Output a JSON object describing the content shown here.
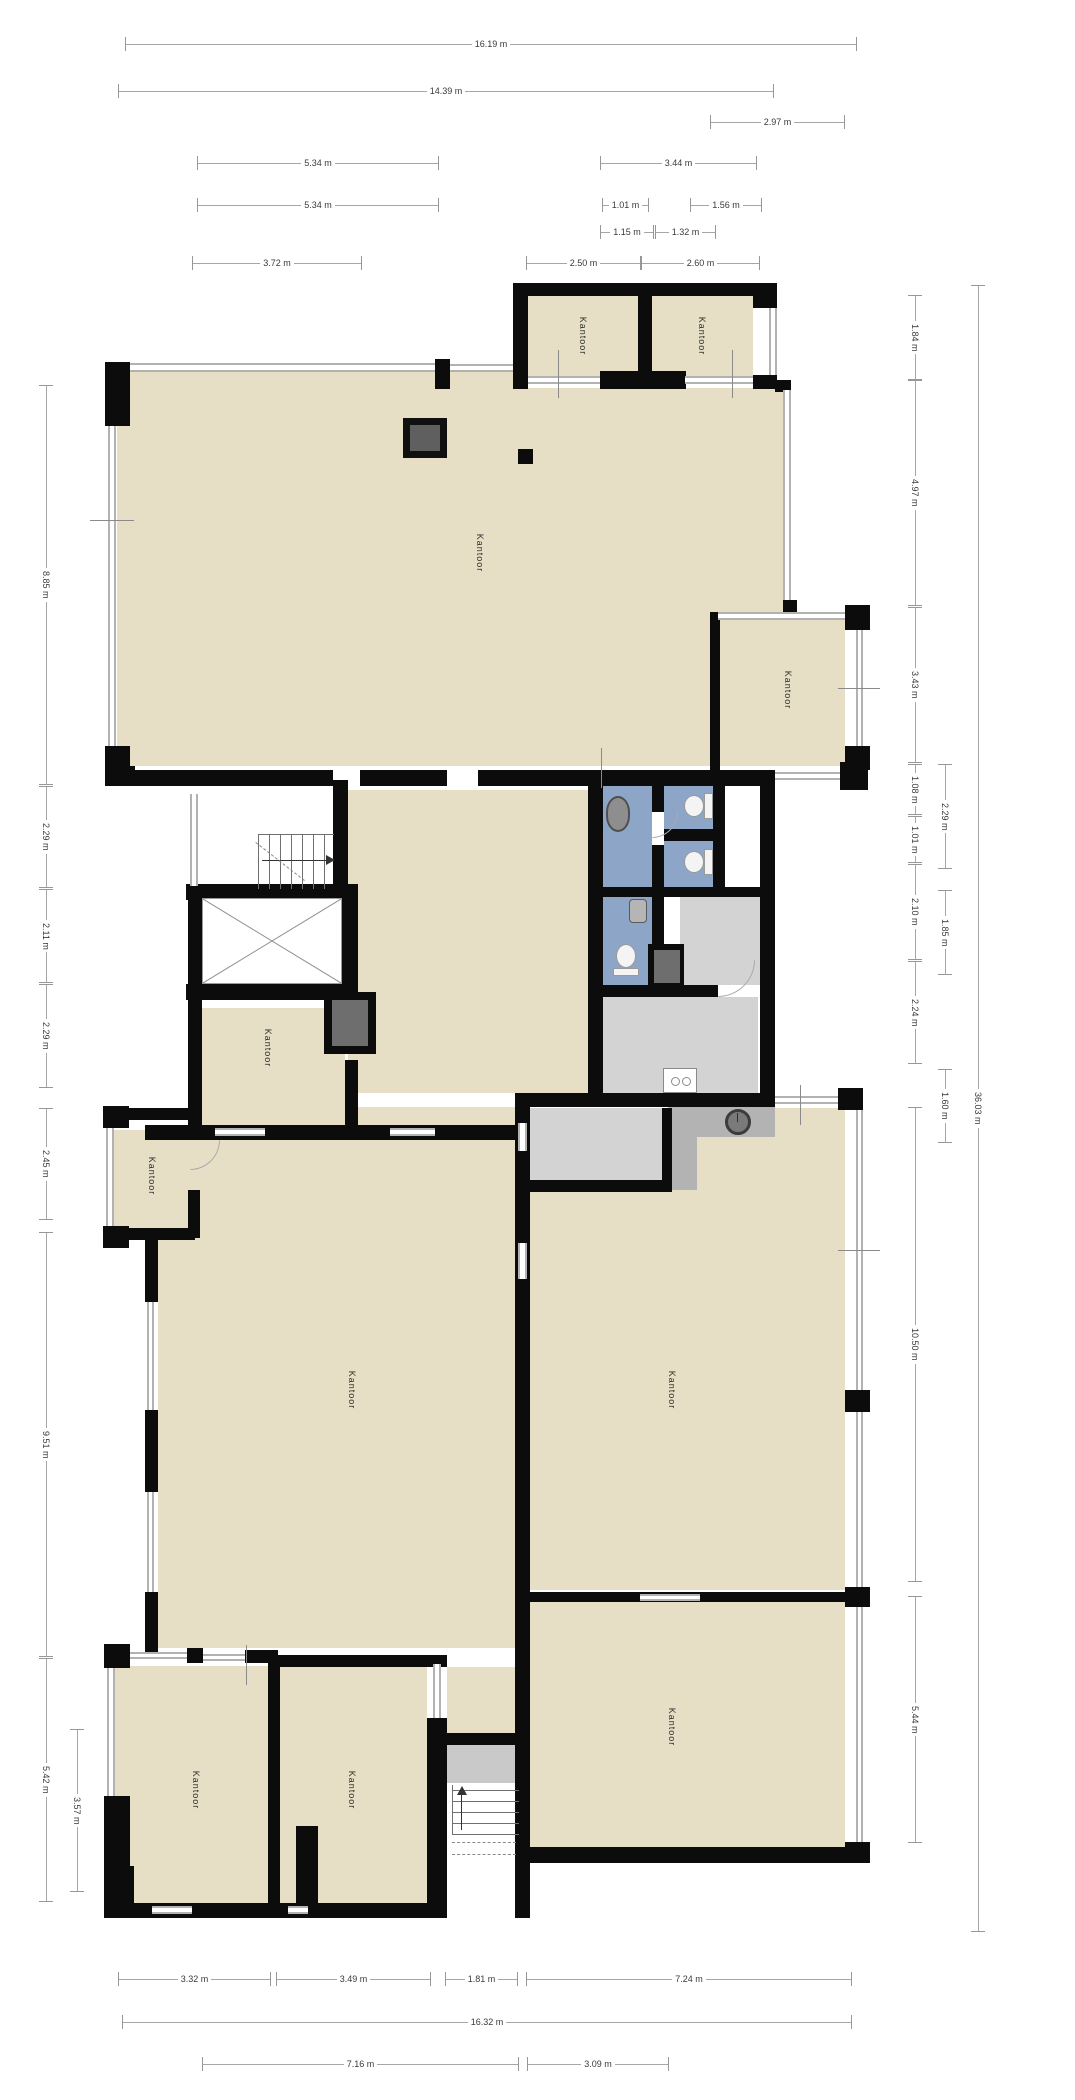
{
  "title": "Floor plan",
  "unit": "m",
  "room_label_text": "Kantoor",
  "palette": {
    "room_fill": "#e7dfc5",
    "sanitary_fill": "#8da5c7",
    "utility_fill": "#d3d3d3",
    "entry_fill": "#b3b3b3",
    "wall": "#0c0c0c",
    "window_line": "#b2b2b2",
    "dimension_line": "#a6a6a6",
    "text": "#3a3a3a"
  },
  "rooms": [
    {
      "label": "Kantoor",
      "x": 583,
      "y": 336
    },
    {
      "label": "Kantoor",
      "x": 702,
      "y": 336
    },
    {
      "label": "Kantoor",
      "x": 480,
      "y": 553
    },
    {
      "label": "Kantoor",
      "x": 788,
      "y": 690
    },
    {
      "label": "Kantoor",
      "x": 268,
      "y": 1048
    },
    {
      "label": "Kantoor",
      "x": 152,
      "y": 1176
    },
    {
      "label": "Kantoor",
      "x": 352,
      "y": 1390
    },
    {
      "label": "Kantoor",
      "x": 672,
      "y": 1390
    },
    {
      "label": "Kantoor",
      "x": 672,
      "y": 1727
    },
    {
      "label": "Kantoor",
      "x": 196,
      "y": 1790
    },
    {
      "label": "Kantoor",
      "x": 352,
      "y": 1790
    }
  ],
  "dims": {
    "h": [
      {
        "t": "16.19 m",
        "x": 125,
        "y": 44,
        "w": 730
      },
      {
        "t": "14.39 m",
        "x": 118,
        "y": 91,
        "w": 654
      },
      {
        "t": "2.97 m",
        "x": 710,
        "y": 122,
        "w": 133
      },
      {
        "t": "5.34 m",
        "x": 197,
        "y": 163,
        "w": 240
      },
      {
        "t": "3.44 m",
        "x": 600,
        "y": 163,
        "w": 155
      },
      {
        "t": "5.34 m",
        "x": 197,
        "y": 205,
        "w": 240
      },
      {
        "t": "1.01 m",
        "x": 602,
        "y": 205,
        "w": 45
      },
      {
        "t": "1.56 m",
        "x": 690,
        "y": 205,
        "w": 70
      },
      {
        "t": "1.15 m",
        "x": 600,
        "y": 232,
        "w": 52
      },
      {
        "t": "1.32 m",
        "x": 655,
        "y": 232,
        "w": 59
      },
      {
        "t": "3.72 m",
        "x": 192,
        "y": 263,
        "w": 168
      },
      {
        "t": "2.50 m",
        "x": 526,
        "y": 263,
        "w": 113
      },
      {
        "t": "2.60 m",
        "x": 641,
        "y": 263,
        "w": 117
      },
      {
        "t": "3.32 m",
        "x": 118,
        "y": 1979,
        "w": 151
      },
      {
        "t": "3.49 m",
        "x": 276,
        "y": 1979,
        "w": 153
      },
      {
        "t": "1.81 m",
        "x": 445,
        "y": 1979,
        "w": 71
      },
      {
        "t": "7.24 m",
        "x": 526,
        "y": 1979,
        "w": 324
      },
      {
        "t": "16.32 m",
        "x": 122,
        "y": 2022,
        "w": 728
      },
      {
        "t": "7.16 m",
        "x": 202,
        "y": 2064,
        "w": 315
      },
      {
        "t": "3.09 m",
        "x": 527,
        "y": 2064,
        "w": 140
      }
    ],
    "v": [
      {
        "t": "8.85 m",
        "x": 46,
        "y": 385,
        "h": 398
      },
      {
        "t": "2.29 m",
        "x": 46,
        "y": 786,
        "h": 100
      },
      {
        "t": "2.11 m",
        "x": 46,
        "y": 889,
        "h": 92
      },
      {
        "t": "2.29 m",
        "x": 46,
        "y": 984,
        "h": 102
      },
      {
        "t": "2.45 m",
        "x": 46,
        "y": 1108,
        "h": 110
      },
      {
        "t": "9.51 m",
        "x": 46,
        "y": 1232,
        "h": 423
      },
      {
        "t": "5.42 m",
        "x": 46,
        "y": 1658,
        "h": 242
      },
      {
        "t": "3.57 m",
        "x": 77,
        "y": 1729,
        "h": 161
      },
      {
        "t": "1.84 m",
        "x": 915,
        "y": 295,
        "h": 83
      },
      {
        "t": "4.97 m",
        "x": 915,
        "y": 380,
        "h": 224
      },
      {
        "t": "3.43 m",
        "x": 915,
        "y": 607,
        "h": 154
      },
      {
        "t": "1.08 m",
        "x": 915,
        "y": 764,
        "h": 49
      },
      {
        "t": "1.01 m",
        "x": 915,
        "y": 816,
        "h": 45
      },
      {
        "t": "2.10 m",
        "x": 915,
        "y": 864,
        "h": 94
      },
      {
        "t": "2.24 m",
        "x": 915,
        "y": 961,
        "h": 101
      },
      {
        "t": "10.50 m",
        "x": 915,
        "y": 1107,
        "h": 473
      },
      {
        "t": "5.44 m",
        "x": 915,
        "y": 1596,
        "h": 245
      },
      {
        "t": "2.29 m",
        "x": 945,
        "y": 764,
        "h": 103
      },
      {
        "t": "1.85 m",
        "x": 945,
        "y": 890,
        "h": 83
      },
      {
        "t": "1.60 m",
        "x": 945,
        "y": 1069,
        "h": 72
      },
      {
        "t": "36.03 m",
        "x": 978,
        "y": 285,
        "h": 1645
      }
    ]
  },
  "plan": {
    "fills": [
      [
        527,
        296,
        112,
        80,
        "beige"
      ],
      [
        652,
        296,
        101,
        80,
        "beige"
      ],
      [
        117,
        371,
        398,
        395,
        "beige"
      ],
      [
        515,
        388,
        268,
        378,
        "beige"
      ],
      [
        718,
        620,
        127,
        146,
        "beige"
      ],
      [
        348,
        790,
        240,
        303,
        "beige"
      ],
      [
        200,
        1008,
        145,
        117,
        "beige"
      ],
      [
        114,
        1130,
        74,
        98,
        "beige"
      ],
      [
        158,
        1140,
        357,
        508,
        "beige"
      ],
      [
        348,
        1107,
        167,
        18,
        "beige"
      ],
      [
        530,
        1190,
        315,
        400,
        "beige"
      ],
      [
        775,
        1108,
        70,
        82,
        "beige"
      ],
      [
        697,
        1133,
        78,
        57,
        "beige"
      ],
      [
        530,
        1602,
        315,
        245,
        "beige"
      ],
      [
        114,
        1666,
        154,
        237,
        "beige"
      ],
      [
        280,
        1667,
        147,
        236,
        "beige"
      ],
      [
        447,
        1667,
        68,
        78,
        "beige"
      ],
      [
        198,
        790,
        137,
        96,
        "white"
      ],
      [
        725,
        782,
        35,
        105,
        "white"
      ],
      [
        602,
        782,
        50,
        105,
        "blue"
      ],
      [
        664,
        782,
        49,
        47,
        "blue"
      ],
      [
        664,
        841,
        49,
        46,
        "blue"
      ],
      [
        600,
        897,
        52,
        88,
        "blue"
      ],
      [
        680,
        897,
        80,
        88,
        "lgray"
      ],
      [
        602,
        997,
        156,
        96,
        "lgray"
      ],
      [
        530,
        1108,
        132,
        72,
        "lgray"
      ],
      [
        668,
        1107,
        107,
        30,
        "mgray"
      ],
      [
        668,
        1137,
        29,
        53,
        "mgray"
      ],
      [
        447,
        1745,
        81,
        158,
        "white"
      ],
      [
        447,
        1745,
        81,
        38,
        "landing"
      ]
    ],
    "walls": [
      [
        513,
        283,
        264,
        13
      ],
      [
        513,
        283,
        15,
        106
      ],
      [
        638,
        293,
        14,
        96
      ],
      [
        753,
        283,
        24,
        25
      ],
      [
        753,
        375,
        24,
        14
      ],
      [
        600,
        371,
        86,
        18
      ],
      [
        105,
        362,
        25,
        64
      ],
      [
        435,
        359,
        15,
        30
      ],
      [
        105,
        746,
        25,
        26
      ],
      [
        105,
        766,
        30,
        20
      ],
      [
        135,
        770,
        198,
        16
      ],
      [
        360,
        770,
        87,
        16
      ],
      [
        478,
        770,
        117,
        16
      ],
      [
        588,
        770,
        187,
        16
      ],
      [
        840,
        762,
        28,
        28
      ],
      [
        775,
        380,
        16,
        12
      ],
      [
        783,
        600,
        14,
        14
      ],
      [
        710,
        612,
        10,
        158
      ],
      [
        845,
        605,
        25,
        25
      ],
      [
        845,
        746,
        25,
        24
      ],
      [
        188,
        884,
        16,
        116
      ],
      [
        333,
        780,
        15,
        106
      ],
      [
        186,
        884,
        172,
        16
      ],
      [
        186,
        984,
        172,
        16
      ],
      [
        342,
        884,
        16,
        116
      ],
      [
        324,
        992,
        52,
        62
      ],
      [
        188,
        994,
        14,
        140
      ],
      [
        345,
        994,
        13,
        40
      ],
      [
        345,
        1060,
        13,
        74
      ],
      [
        145,
        1125,
        375,
        15
      ],
      [
        103,
        1106,
        26,
        22
      ],
      [
        103,
        1226,
        26,
        22
      ],
      [
        129,
        1108,
        60,
        12
      ],
      [
        129,
        1228,
        66,
        12
      ],
      [
        188,
        1108,
        12,
        30
      ],
      [
        188,
        1190,
        12,
        48
      ],
      [
        145,
        1240,
        13,
        62
      ],
      [
        145,
        1410,
        13,
        82
      ],
      [
        145,
        1592,
        13,
        66
      ],
      [
        515,
        1107,
        15,
        811
      ],
      [
        588,
        770,
        15,
        337
      ],
      [
        760,
        782,
        15,
        325
      ],
      [
        652,
        782,
        12,
        30
      ],
      [
        652,
        845,
        12,
        42
      ],
      [
        664,
        829,
        49,
        12
      ],
      [
        713,
        782,
        12,
        105
      ],
      [
        588,
        887,
        184,
        10
      ],
      [
        652,
        897,
        12,
        51
      ],
      [
        648,
        944,
        36,
        45
      ],
      [
        588,
        985,
        130,
        12
      ],
      [
        515,
        1093,
        260,
        14
      ],
      [
        838,
        1088,
        25,
        22
      ],
      [
        530,
        1180,
        142,
        12
      ],
      [
        662,
        1108,
        10,
        84
      ],
      [
        530,
        1592,
        325,
        10
      ],
      [
        528,
        1847,
        335,
        16
      ],
      [
        845,
        1390,
        25,
        22
      ],
      [
        845,
        1587,
        25,
        20
      ],
      [
        845,
        1842,
        25,
        21
      ],
      [
        427,
        1718,
        20,
        200
      ],
      [
        447,
        1733,
        81,
        12
      ],
      [
        104,
        1644,
        26,
        24
      ],
      [
        187,
        1648,
        16,
        15
      ],
      [
        245,
        1650,
        33,
        13
      ],
      [
        268,
        1655,
        179,
        12
      ],
      [
        268,
        1655,
        12,
        263
      ],
      [
        104,
        1796,
        26,
        74
      ],
      [
        104,
        1866,
        30,
        52
      ],
      [
        104,
        1903,
        343,
        15
      ],
      [
        296,
        1826,
        22,
        80
      ],
      [
        518,
        449,
        15,
        15
      ]
    ],
    "windows": {
      "h": [
        [
          130,
          363,
          305,
          9
        ],
        [
          450,
          364,
          63,
          8
        ],
        [
          528,
          376,
          72,
          8
        ],
        [
          685,
          376,
          68,
          8
        ],
        [
          775,
          772,
          65,
          8
        ],
        [
          718,
          612,
          127,
          8
        ],
        [
          775,
          1096,
          63,
          8
        ],
        [
          130,
          1652,
          57,
          7
        ],
        [
          203,
          1654,
          42,
          7
        ],
        [
          152,
          1906,
          40,
          8
        ],
        [
          288,
          1906,
          20,
          8
        ],
        [
          215,
          1128,
          50,
          8
        ],
        [
          390,
          1128,
          45,
          8
        ],
        [
          640,
          1594,
          60,
          7
        ]
      ],
      "v": [
        [
          108,
          426,
          8,
          320
        ],
        [
          769,
          308,
          8,
          67
        ],
        [
          783,
          390,
          8,
          210
        ],
        [
          856,
          630,
          7,
          116
        ],
        [
          190,
          794,
          8,
          92
        ],
        [
          106,
          1128,
          8,
          98
        ],
        [
          147,
          1302,
          7,
          108
        ],
        [
          147,
          1492,
          7,
          100
        ],
        [
          518,
          1123,
          9,
          28
        ],
        [
          518,
          1243,
          9,
          36
        ],
        [
          856,
          1110,
          7,
          280
        ],
        [
          856,
          1412,
          7,
          175
        ],
        [
          856,
          1607,
          7,
          235
        ],
        [
          107,
          1668,
          8,
          128
        ],
        [
          433,
          1664,
          8,
          54
        ]
      ]
    },
    "ticks": {
      "v": [
        [
          558,
          350,
          1,
          48
        ],
        [
          732,
          350,
          1,
          48
        ],
        [
          601,
          748,
          1,
          40
        ],
        [
          800,
          1085,
          1,
          40
        ],
        [
          246,
          1645,
          1,
          40
        ]
      ],
      "h": [
        [
          90,
          520,
          44,
          1
        ],
        [
          838,
          688,
          42,
          1
        ],
        [
          838,
          1250,
          42,
          1
        ]
      ]
    },
    "arcs": [
      [
        718,
        960,
        37,
        37
      ],
      [
        190,
        1140,
        30,
        30
      ],
      [
        652,
        812,
        26,
        26
      ]
    ],
    "elevator": {
      "inner": [
        202,
        898,
        140,
        86
      ]
    },
    "shafts": [
      [
        332,
        1000,
        36,
        46
      ],
      [
        654,
        950,
        26,
        33
      ]
    ],
    "stairs_top": {
      "steps": [
        258,
        834,
        76,
        54
      ],
      "arrow": [
        262,
        860,
        64,
        1
      ],
      "head": [
        326,
        855
      ],
      "dash": [
        256,
        842,
        62
      ]
    },
    "stairs_bottom": {
      "steps": [
        452,
        1785,
        66,
        50
      ],
      "arrow": [
        461,
        1792,
        1,
        38
      ],
      "head": [
        457,
        1786
      ],
      "dashes": [
        [
          452,
          1842,
          64
        ],
        [
          452,
          1854,
          64
        ]
      ]
    },
    "fixtures": [
      {
        "type": "sink-big",
        "name": "washbasin-icon",
        "r": [
          606,
          796,
          24,
          36
        ]
      },
      {
        "type": "toilet-h",
        "name": "toilet-icon",
        "r": [
          684,
          793,
          30,
          26
        ]
      },
      {
        "type": "toilet-h",
        "name": "toilet-icon",
        "r": [
          684,
          849,
          30,
          26
        ]
      },
      {
        "type": "toilet-v",
        "name": "toilet-icon",
        "r": [
          613,
          944,
          26,
          32
        ]
      },
      {
        "type": "sink-small",
        "name": "hand-basin-icon",
        "r": [
          629,
          899,
          18,
          24
        ]
      },
      {
        "type": "boiler",
        "name": "boiler-icon",
        "r": [
          663,
          1068,
          34,
          25
        ]
      },
      {
        "type": "spiral",
        "name": "round-fixture-icon",
        "r": [
          725,
          1109,
          26,
          26
        ]
      },
      {
        "type": "dark-box",
        "name": "duct-box-icon",
        "r": [
          403,
          418,
          44,
          40
        ]
      }
    ]
  }
}
